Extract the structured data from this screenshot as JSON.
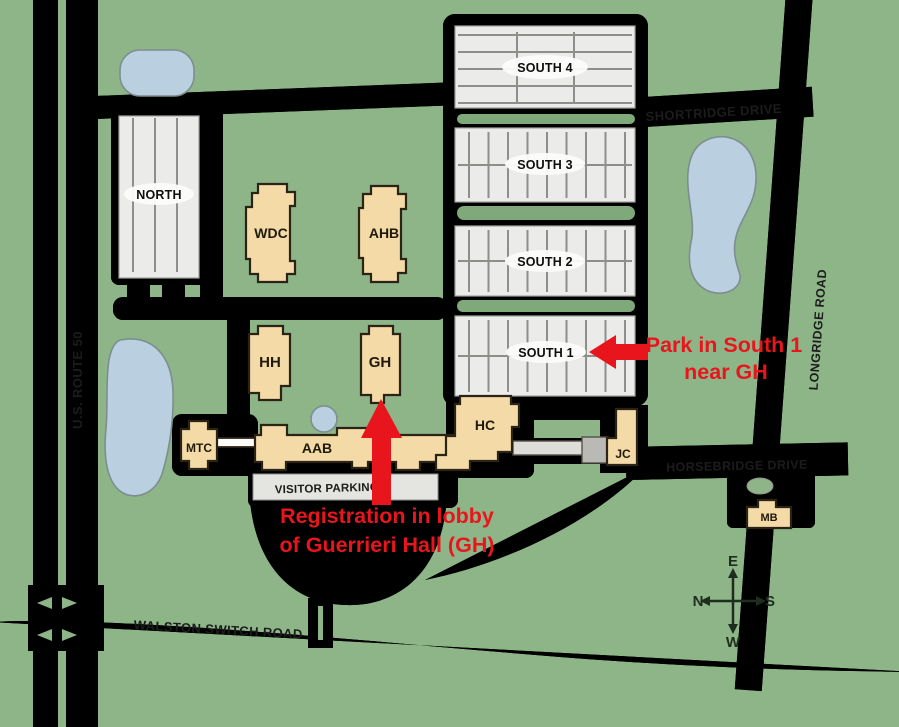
{
  "map": {
    "title": "Campus map with parking and registration directions",
    "colors": {
      "grass": "#8DB588",
      "divider_green": "#7FA97A",
      "road": "#FCFCFA",
      "road_outline": "#5F6A58",
      "parking_gray": "#EBEBE9",
      "stripe_gray": "#8E8E8B",
      "building_tan": "#F3DAA6",
      "building_outline": "#2B2315",
      "pond_blue": "#BACFDF",
      "annotation_red": "#E8161C",
      "label_dark": "#1C1C1C"
    },
    "roads": [
      {
        "id": "us-route-50",
        "label": "U.S. ROUTE 50"
      },
      {
        "id": "shortridge-drive",
        "label": "SHORTRIDGE DRIVE"
      },
      {
        "id": "longridge-road",
        "label": "LONGRIDGE ROAD"
      },
      {
        "id": "horsebridge-drive",
        "label": "HORSEBRIDGE DRIVE"
      },
      {
        "id": "walston-switch-road",
        "label": "WALSTON SWITCH ROAD"
      }
    ],
    "parking_lots": [
      {
        "id": "north",
        "label": "NORTH"
      },
      {
        "id": "south-4",
        "label": "SOUTH 4"
      },
      {
        "id": "south-3",
        "label": "SOUTH 3"
      },
      {
        "id": "south-2",
        "label": "SOUTH 2"
      },
      {
        "id": "south-1",
        "label": "SOUTH 1"
      },
      {
        "id": "visitor",
        "label": "VISITOR PARKING"
      }
    ],
    "buildings": [
      {
        "id": "wdc",
        "label": "WDC"
      },
      {
        "id": "ahb",
        "label": "AHB"
      },
      {
        "id": "hh",
        "label": "HH"
      },
      {
        "id": "gh",
        "label": "GH"
      },
      {
        "id": "mtc",
        "label": "MTC"
      },
      {
        "id": "aab",
        "label": "AAB"
      },
      {
        "id": "hc",
        "label": "HC"
      },
      {
        "id": "jc",
        "label": "JC"
      },
      {
        "id": "mb",
        "label": "MB"
      }
    ],
    "annotations": {
      "park": {
        "line1": "Park in South 1",
        "line2": "near GH"
      },
      "registration": {
        "line1": "Registration in lobby",
        "line2": "of Guerrieri Hall (GH)"
      }
    },
    "compass": {
      "top": "E",
      "right": "S",
      "bottom": "W",
      "left": "N"
    }
  }
}
